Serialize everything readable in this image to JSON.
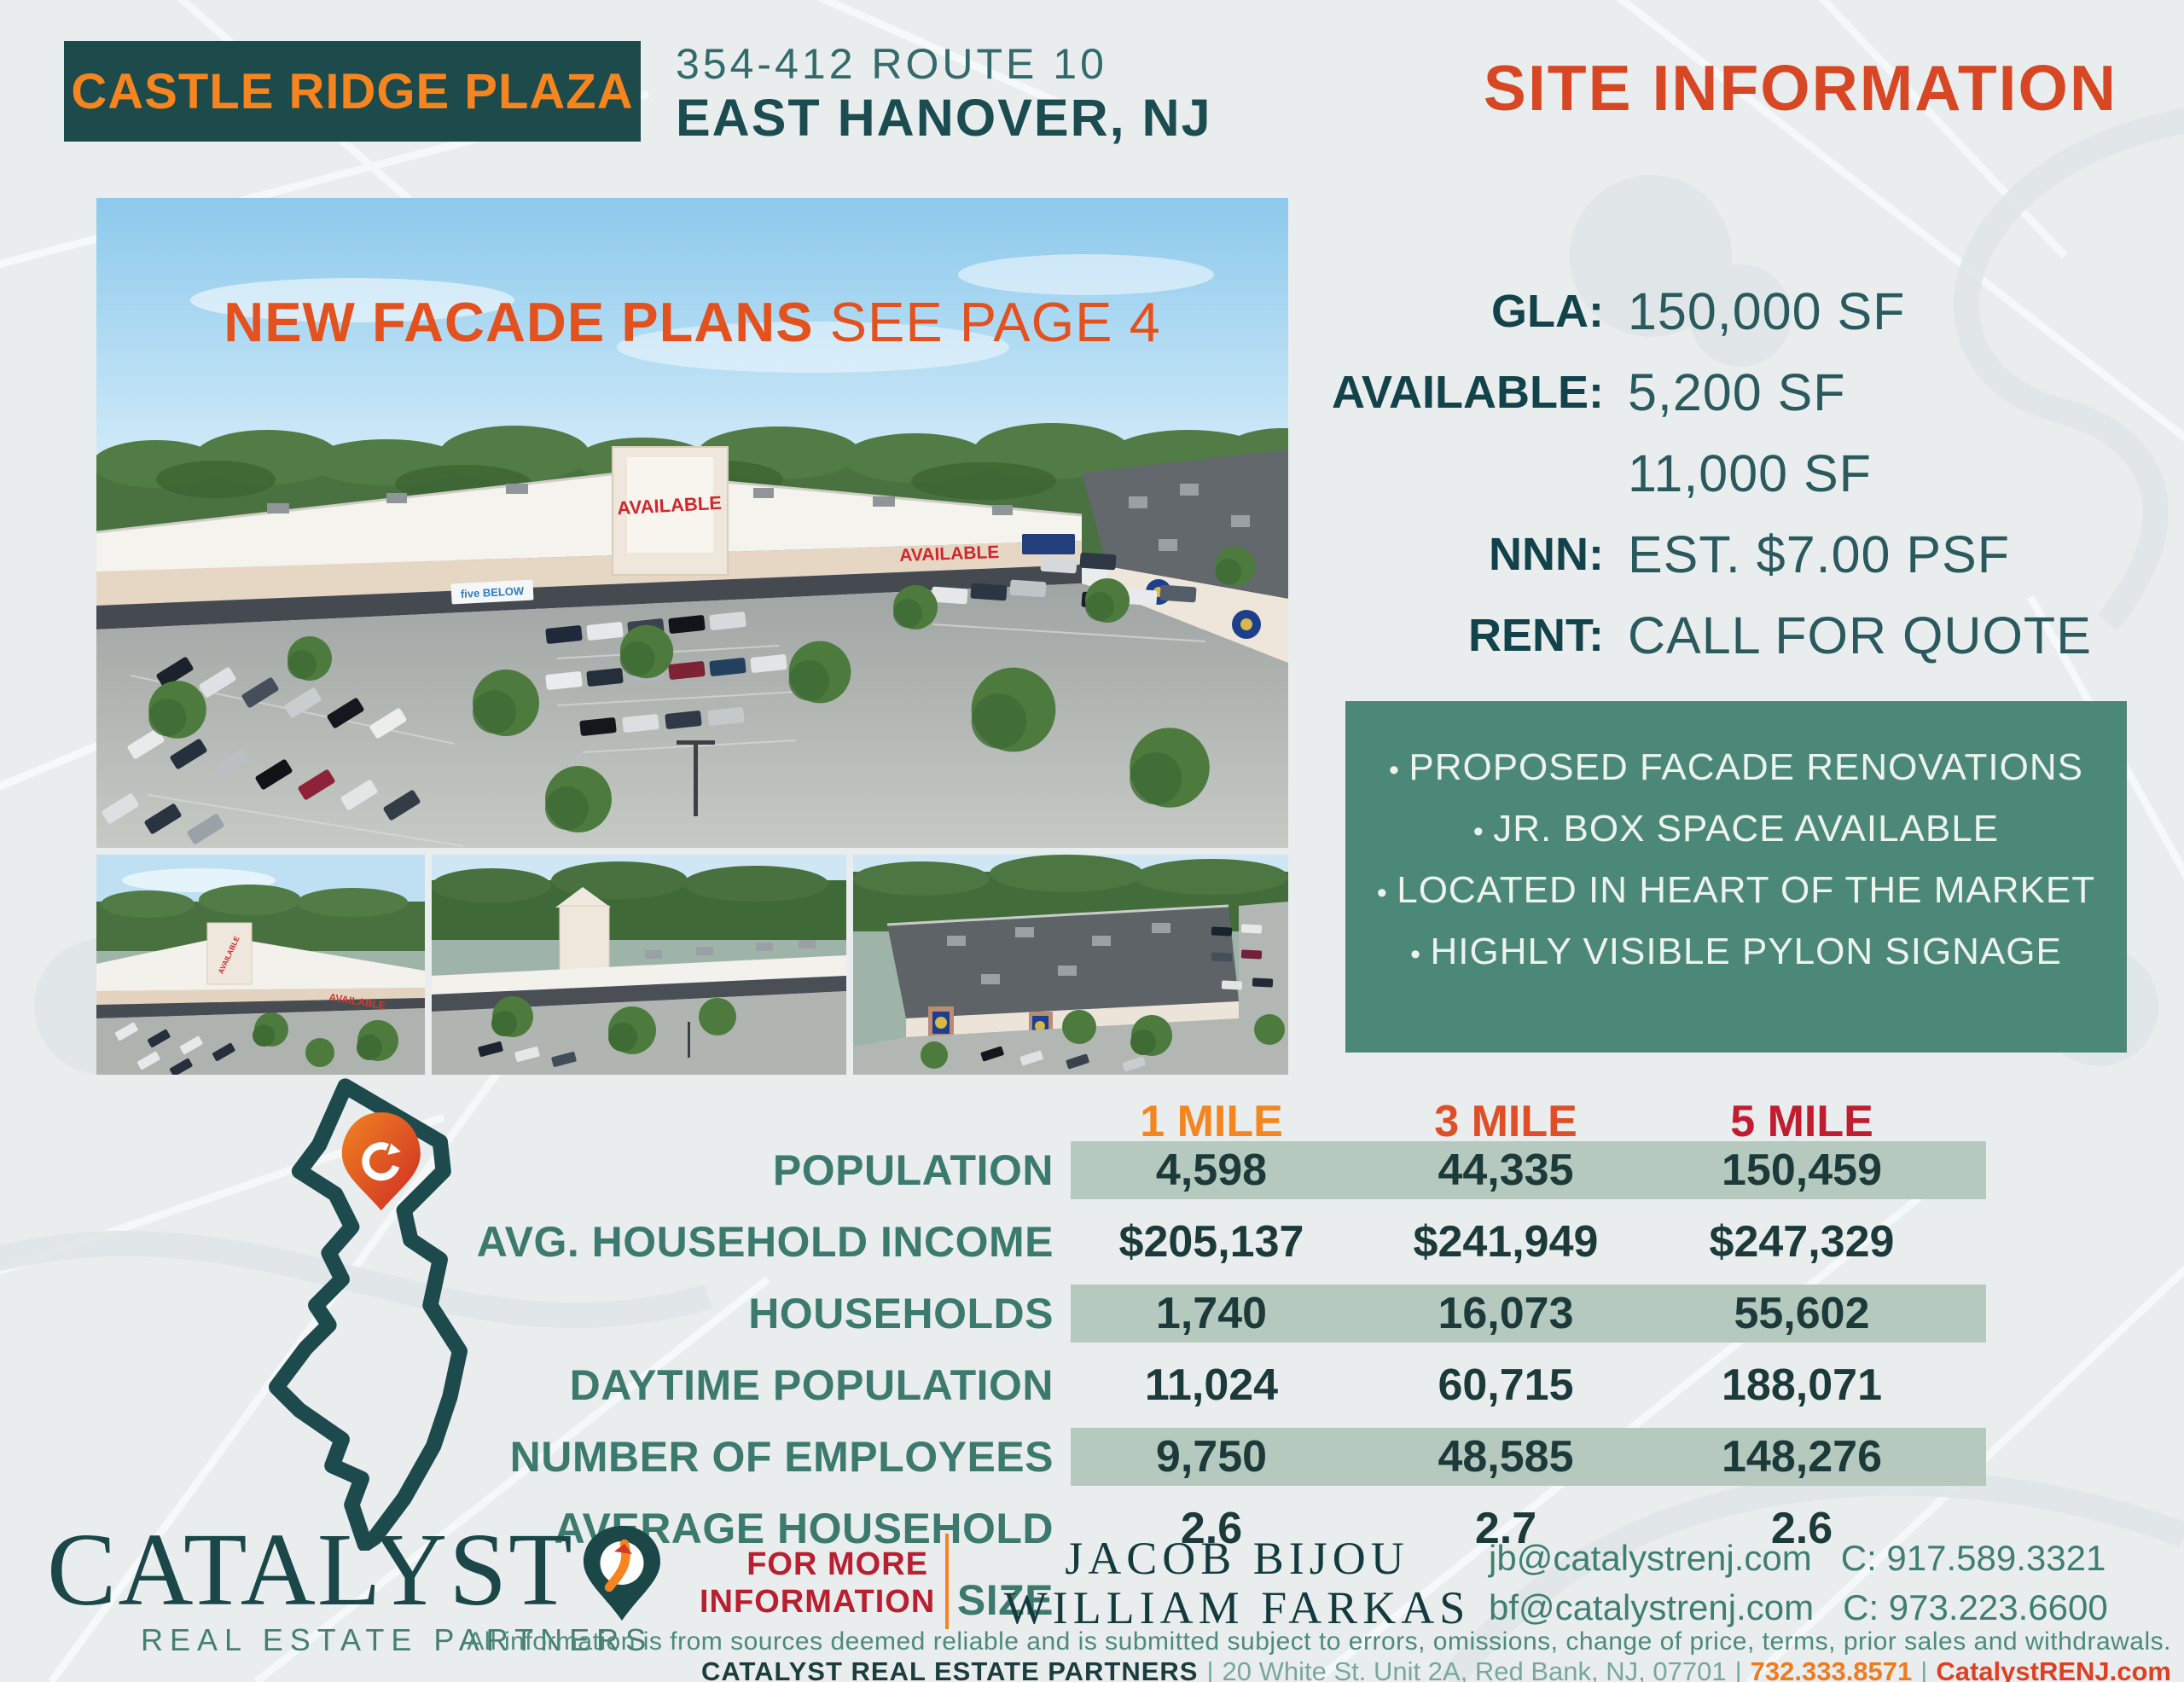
{
  "header": {
    "property_name": "CASTLE RIDGE PLAZA",
    "address_line1": "354-412 ROUTE 10",
    "address_line2": "EAST HANOVER, NJ",
    "page_title": "SITE INFORMATION"
  },
  "hero": {
    "overlay_bold": "NEW FACADE PLANS",
    "overlay_regular": "SEE PAGE 4",
    "signs": {
      "tower": "AVAILABLE",
      "facade": "AVAILABLE",
      "store1": "five BELOW",
      "store2": "carter's"
    }
  },
  "site_info": {
    "rows": [
      {
        "label": "GLA:",
        "value": "150,000 SF"
      },
      {
        "label": "AVAILABLE:",
        "value": "5,200 SF"
      },
      {
        "label": "",
        "value": "11,000 SF"
      },
      {
        "label": "NNN:",
        "value": "EST. $7.00 PSF"
      },
      {
        "label": "RENT:",
        "value": "CALL FOR QUOTE"
      }
    ]
  },
  "highlights": [
    "PROPOSED FACADE RENOVATIONS",
    "JR. BOX SPACE AVAILABLE",
    "LOCATED IN HEART OF THE MARKET",
    "HIGHLY VISIBLE PYLON SIGNAGE"
  ],
  "demographics": {
    "columns": [
      "1 MILE",
      "3 MILE",
      "5 MILE"
    ],
    "rows": [
      {
        "label": "POPULATION",
        "values": [
          "4,598",
          "44,335",
          "150,459"
        ]
      },
      {
        "label": "AVG. HOUSEHOLD INCOME",
        "values": [
          "$205,137",
          "$241,949",
          "$247,329"
        ]
      },
      {
        "label": "HOUSEHOLDS",
        "values": [
          "1,740",
          "16,073",
          "55,602"
        ]
      },
      {
        "label": "DAYTIME POPULATION",
        "values": [
          "11,024",
          "60,715",
          "188,071"
        ]
      },
      {
        "label": "NUMBER OF EMPLOYEES",
        "values": [
          "9,750",
          "48,585",
          "148,276"
        ]
      },
      {
        "label": "AVERAGE HOUSEHOLD SIZE",
        "values": [
          "2.6",
          "2.7",
          "2.6"
        ]
      }
    ]
  },
  "footer": {
    "brand_name": "CATALYST",
    "brand_subtitle": "REAL ESTATE PARTNERS",
    "for_more_line1": "FOR MORE",
    "for_more_line2": "INFORMATION",
    "contacts": [
      {
        "name": "JACOB BIJOU",
        "email": "jb@catalystrenj.com",
        "phone": "C: 917.589.3321"
      },
      {
        "name": "WILLIAM FARKAS",
        "email": "bf@catalystrenj.com",
        "phone": "C: 973.223.6600"
      }
    ],
    "disclaimer": "All information is from sources deemed reliable and is submitted subject to errors, omissions, change of price, terms, prior sales and withdrawals.",
    "company_line": {
      "company": "CATALYST REAL ESTATE PARTNERS",
      "sep": "|",
      "address": "20 White St. Unit 2A, Red Bank, NJ, 07701",
      "phone": "732.333.8571",
      "website": "CatalystRENJ.com"
    }
  },
  "icons": {
    "brand_pin": "location-pin-arrow-icon",
    "map_pin": "location-pin-icon"
  },
  "colors": {
    "dark_teal": "#1d4a4b",
    "teal_green": "#3d7a6e",
    "orange": "#f5831f",
    "red_orange": "#d74724",
    "red": "#c11d30",
    "sage_band": "#b5c9be",
    "highlight_box": "#4c8878",
    "background": "#e9edee"
  }
}
